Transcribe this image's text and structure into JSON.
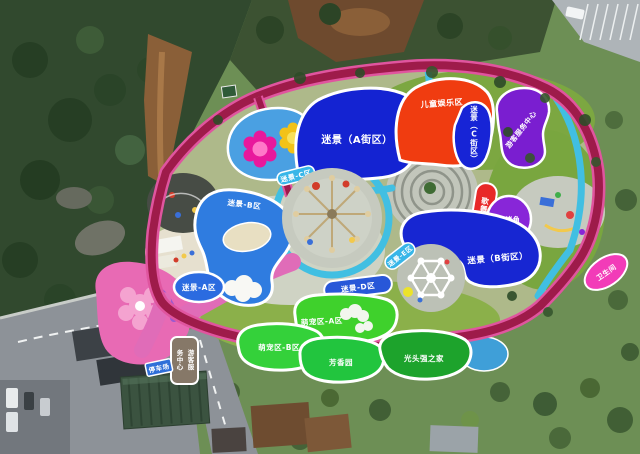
{
  "map": {
    "type": "aerial-theme-park-map",
    "zones": {
      "maze_street_a": {
        "label": "迷景（A街区）",
        "color": "#1423d2"
      },
      "children_play": {
        "label": "儿童娱乐区",
        "color": "#f03c10"
      },
      "maze_street_c": {
        "label": "迷景（C街区）",
        "color": "#1724d6"
      },
      "visitor_center_zone": {
        "label": "游客服务中心",
        "color": "#7a1ed0"
      },
      "performance": {
        "label": "歌舞演出区",
        "color": "#e82828"
      },
      "bbq_corner": {
        "label": "烧烤角",
        "color": "#8826d8"
      },
      "maze_street_b": {
        "label": "迷景（B街区）",
        "color": "#1726d2"
      },
      "maze_a": {
        "label": "迷景-A区",
        "color": "#2b6be0"
      },
      "maze_b": {
        "label": "迷景-B区",
        "color": "#2f7ce0"
      },
      "maze_c": {
        "label": "迷景-C区",
        "color": "#38b6e8"
      },
      "maze_d": {
        "label": "迷景-D区",
        "color": "#2857d8"
      },
      "maze_e": {
        "label": "迷景-E区",
        "color": "#38b6e8"
      },
      "pets_a": {
        "label": "萌宠区-A区",
        "color": "#3fd12c"
      },
      "pets_b": {
        "label": "萌宠区-B区",
        "color": "#34d13a"
      },
      "fragrance_garden": {
        "label": "芳香园",
        "color": "#22c53e"
      },
      "logger_vick_home": {
        "label": "光头强之家",
        "color": "#1da32c"
      },
      "restroom": {
        "label": "卫生间",
        "color": "#f23cb8"
      }
    },
    "signs": {
      "visitor_service": {
        "col1": "游客服",
        "col2": "务中心",
        "color": "#867868"
      },
      "parking": {
        "label": "停车场",
        "color": "#2f6fd8"
      }
    },
    "palette": {
      "loop_casing": "#e0559f",
      "loop_core": "#9e1b4a",
      "water": "#41bfe2",
      "pink_path": "#e06cb8",
      "pond": "#4aa0e2",
      "plaza": "#c6cabf",
      "lawn": "#7ca741",
      "forest": "#31492e"
    }
  }
}
